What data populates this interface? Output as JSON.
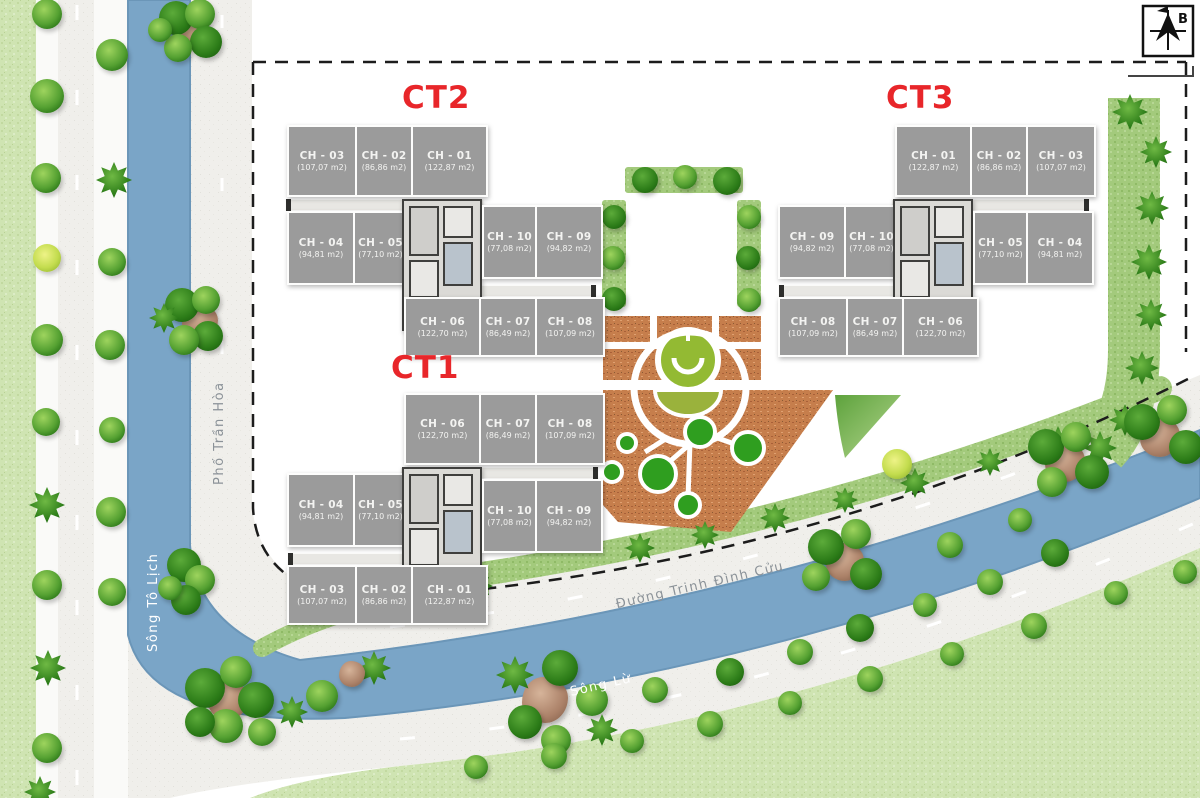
{
  "compass": {
    "label": "B"
  },
  "streets": {
    "song_to_lich": "Sông Tô Lịch",
    "pho_tran_hoa": "Phố Trần Hòa",
    "duong_trinh_dinh_cuu": "Đường Trịnh Đình Cửu",
    "song_lu": "Sông Lừ"
  },
  "towers": [
    {
      "label": "CT2",
      "r1": [
        {
          "name": "CH - 03",
          "area": "(107,07 m2)"
        },
        {
          "name": "CH - 02",
          "area": "(86,86 m2)"
        },
        {
          "name": "CH - 01",
          "area": "(122,87 m2)"
        }
      ],
      "r2l": [
        {
          "name": "CH - 04",
          "area": "(94,81 m2)"
        },
        {
          "name": "CH - 05",
          "area": "(77,10 m2)"
        }
      ],
      "r2r": [
        {
          "name": "CH - 10",
          "area": "(77,08 m2)"
        },
        {
          "name": "CH - 09",
          "area": "(94,82 m2)"
        }
      ],
      "r3": [
        {
          "name": "CH - 06",
          "area": "(122,70 m2)"
        },
        {
          "name": "CH - 07",
          "area": "(86,49 m2)"
        },
        {
          "name": "CH - 08",
          "area": "(107,09 m2)"
        }
      ]
    },
    {
      "label": "CT3",
      "r1": [
        {
          "name": "CH - 01",
          "area": "(122,87 m2)"
        },
        {
          "name": "CH - 02",
          "area": "(86,86 m2)"
        },
        {
          "name": "CH - 03",
          "area": "(107,07 m2)"
        }
      ],
      "r2l": [
        {
          "name": "CH - 09",
          "area": "(94,82 m2)"
        },
        {
          "name": "CH - 10",
          "area": "(77,08 m2)"
        }
      ],
      "r2r": [
        {
          "name": "CH - 05",
          "area": "(77,10 m2)"
        },
        {
          "name": "CH - 04",
          "area": "(94,81 m2)"
        }
      ],
      "r3": [
        {
          "name": "CH - 08",
          "area": "(107,09 m2)"
        },
        {
          "name": "CH - 07",
          "area": "(86,49 m2)"
        },
        {
          "name": "CH - 06",
          "area": "(122,70 m2)"
        }
      ]
    },
    {
      "label": "CT1",
      "r1": [
        {
          "name": "CH - 06",
          "area": "(122,70 m2)"
        },
        {
          "name": "CH - 07",
          "area": "(86,49 m2)"
        },
        {
          "name": "CH - 08",
          "area": "(107,09 m2)"
        }
      ],
      "r2l": [
        {
          "name": "CH - 04",
          "area": "(94,81 m2)"
        },
        {
          "name": "CH - 05",
          "area": "(77,10 m2)"
        }
      ],
      "r2r": [
        {
          "name": "CH - 10",
          "area": "(77,08 m2)"
        },
        {
          "name": "CH - 09",
          "area": "(94,82 m2)"
        }
      ],
      "r3": [
        {
          "name": "CH - 03",
          "area": "(107,07 m2)"
        },
        {
          "name": "CH - 02",
          "area": "(86,86 m2)"
        },
        {
          "name": "CH - 01",
          "area": "(122,87 m2)"
        }
      ]
    }
  ],
  "colors": {
    "tower_label": "#e8262a",
    "unit_fill": "#9b9b9b",
    "river": "#7aa5c7",
    "road": "#f0efeb",
    "lawn": "#cfe4b2",
    "hedge": "#a3ca7c",
    "plaza": "#c67e4c",
    "plaza_green": "#2f9e1f",
    "fountain_green": "#93ba33",
    "boundary": "#1c1c1c"
  }
}
